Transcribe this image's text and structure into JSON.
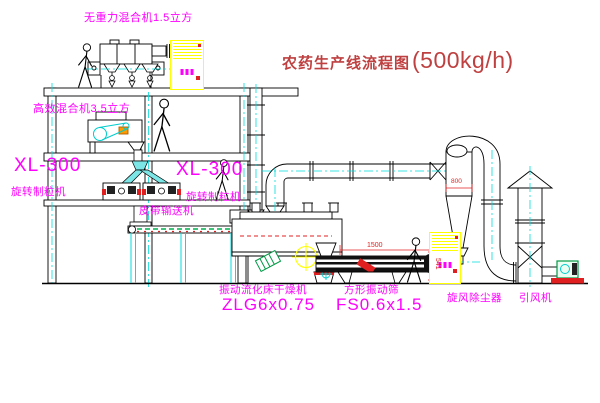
{
  "title": {
    "prefix": "农药生产线流程图",
    "capacity": "(500kg/h)"
  },
  "labels": {
    "gravity_mixer": "无重力混合机1.5立方",
    "high_eff_mixer": "高效混合机3.5立方",
    "xl_left_model": "XL-300",
    "xl_left_name": "旋转制粒机",
    "xl_mid_model": "XL-300",
    "xl_mid_name": "旋转制粒机",
    "belt_conveyor": "皮带输送机",
    "dryer_name": "振动流化床干燥机",
    "dryer_model": "ZLG6x0.75",
    "screen_name": "方形振动筛",
    "screen_model": "FS0.6x1.5",
    "cyclone_name": "旋风除尘器",
    "fan_name": "引风机"
  },
  "dimensions": {
    "screen_length": "1500",
    "screen_height": "541",
    "cyclone_dia": "800"
  },
  "colors": {
    "line": "#000000",
    "centerline": "#00dcdc",
    "label_magenta": "#ff00ff",
    "title_red": "#bf4040",
    "cabinet_yellow": "#ffff00",
    "accent_red": "#e02020",
    "motor_green": "#009944",
    "chute_cyan": "#7ce6e6",
    "conveyor_green": "#00b050"
  }
}
